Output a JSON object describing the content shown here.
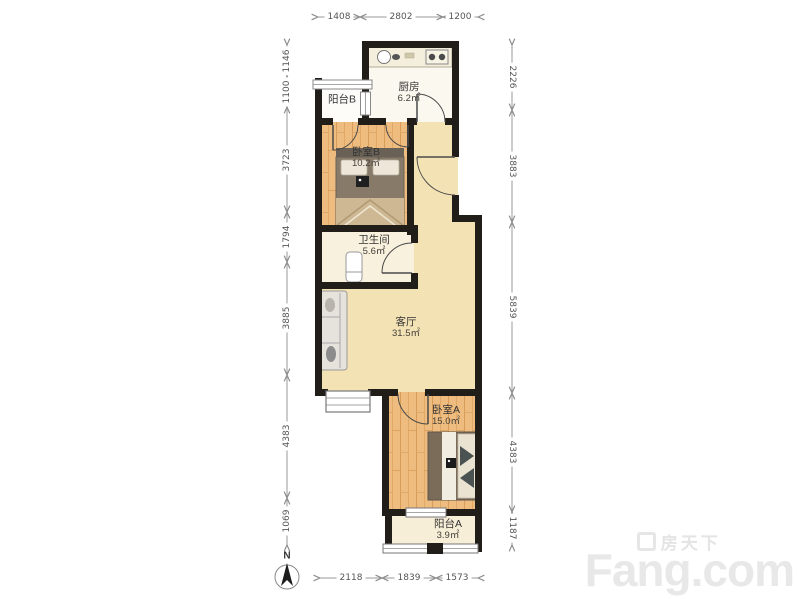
{
  "compass": {
    "label": "N"
  },
  "watermark": {
    "brand_cn": "房天下",
    "brand_en": "Fang.com"
  },
  "rooms": {
    "balcony_b": {
      "name": "阳台B"
    },
    "kitchen": {
      "name": "厨房",
      "area": "6.2㎡"
    },
    "bedroom_b": {
      "name": "卧室B",
      "area": "10.2㎡"
    },
    "bathroom": {
      "name": "卫生间",
      "area": "5.6㎡"
    },
    "living": {
      "name": "客厅",
      "area": "31.5㎡"
    },
    "bedroom_a": {
      "name": "卧室A",
      "area": "15.0㎡"
    },
    "balcony_a": {
      "name": "阳台A",
      "area": "3.9㎡"
    }
  },
  "dimensions": {
    "top": [
      "1408",
      "2802",
      "1200"
    ],
    "bottom": [
      "2118",
      "1839",
      "1573"
    ],
    "left": [
      "1146",
      "1100",
      "3723",
      "1794",
      "3885",
      "4383",
      "1069"
    ],
    "right": [
      "2226",
      "3883",
      "5839",
      "4383",
      "1187"
    ]
  },
  "colors": {
    "wall": "#211d19",
    "wood_floor": "#eebc7f",
    "living_floor": "#f3e2b4",
    "bath_floor": "#f8f1de",
    "kitchen_floor": "#fbf8ef",
    "balcony_a_floor": "#f7eed7",
    "balcony_b_floor": "#fdfcf8",
    "dimension_line": "#9a9a9a",
    "watermark": "#e8e8e8"
  }
}
